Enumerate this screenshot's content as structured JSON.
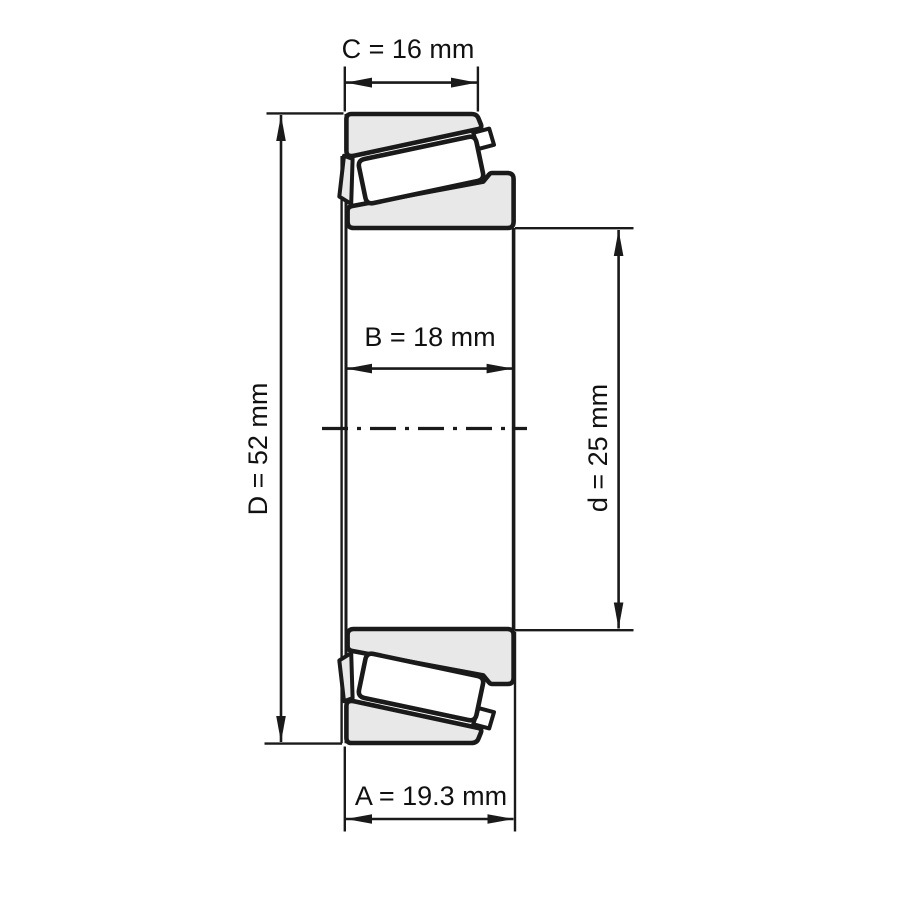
{
  "diagram": {
    "kind": "bearing-cross-section-dimension-drawing",
    "dimensions": [
      {
        "id": "C",
        "label": "C = 16 mm",
        "value": "16",
        "unit": "mm",
        "orientation": "horizontal",
        "position": "top"
      },
      {
        "id": "D",
        "label": "D = 52 mm",
        "value": "52",
        "unit": "mm",
        "orientation": "vertical",
        "position": "left"
      },
      {
        "id": "B",
        "label": "B = 18 mm",
        "value": "18",
        "unit": "mm",
        "orientation": "horizontal",
        "position": "middle"
      },
      {
        "id": "d",
        "label": "d = 25 mm",
        "value": "25",
        "unit": "mm",
        "orientation": "vertical",
        "position": "right"
      },
      {
        "id": "A",
        "label": "A = 19.3 mm",
        "value": "19.3",
        "unit": "mm",
        "orientation": "horizontal",
        "position": "bottom"
      }
    ],
    "colors": {
      "outline": "#1a1a1a",
      "ring_fill": "#e8e8e8",
      "roller_fill": "#ffffff",
      "background": "#ffffff",
      "text": "#111111"
    }
  }
}
